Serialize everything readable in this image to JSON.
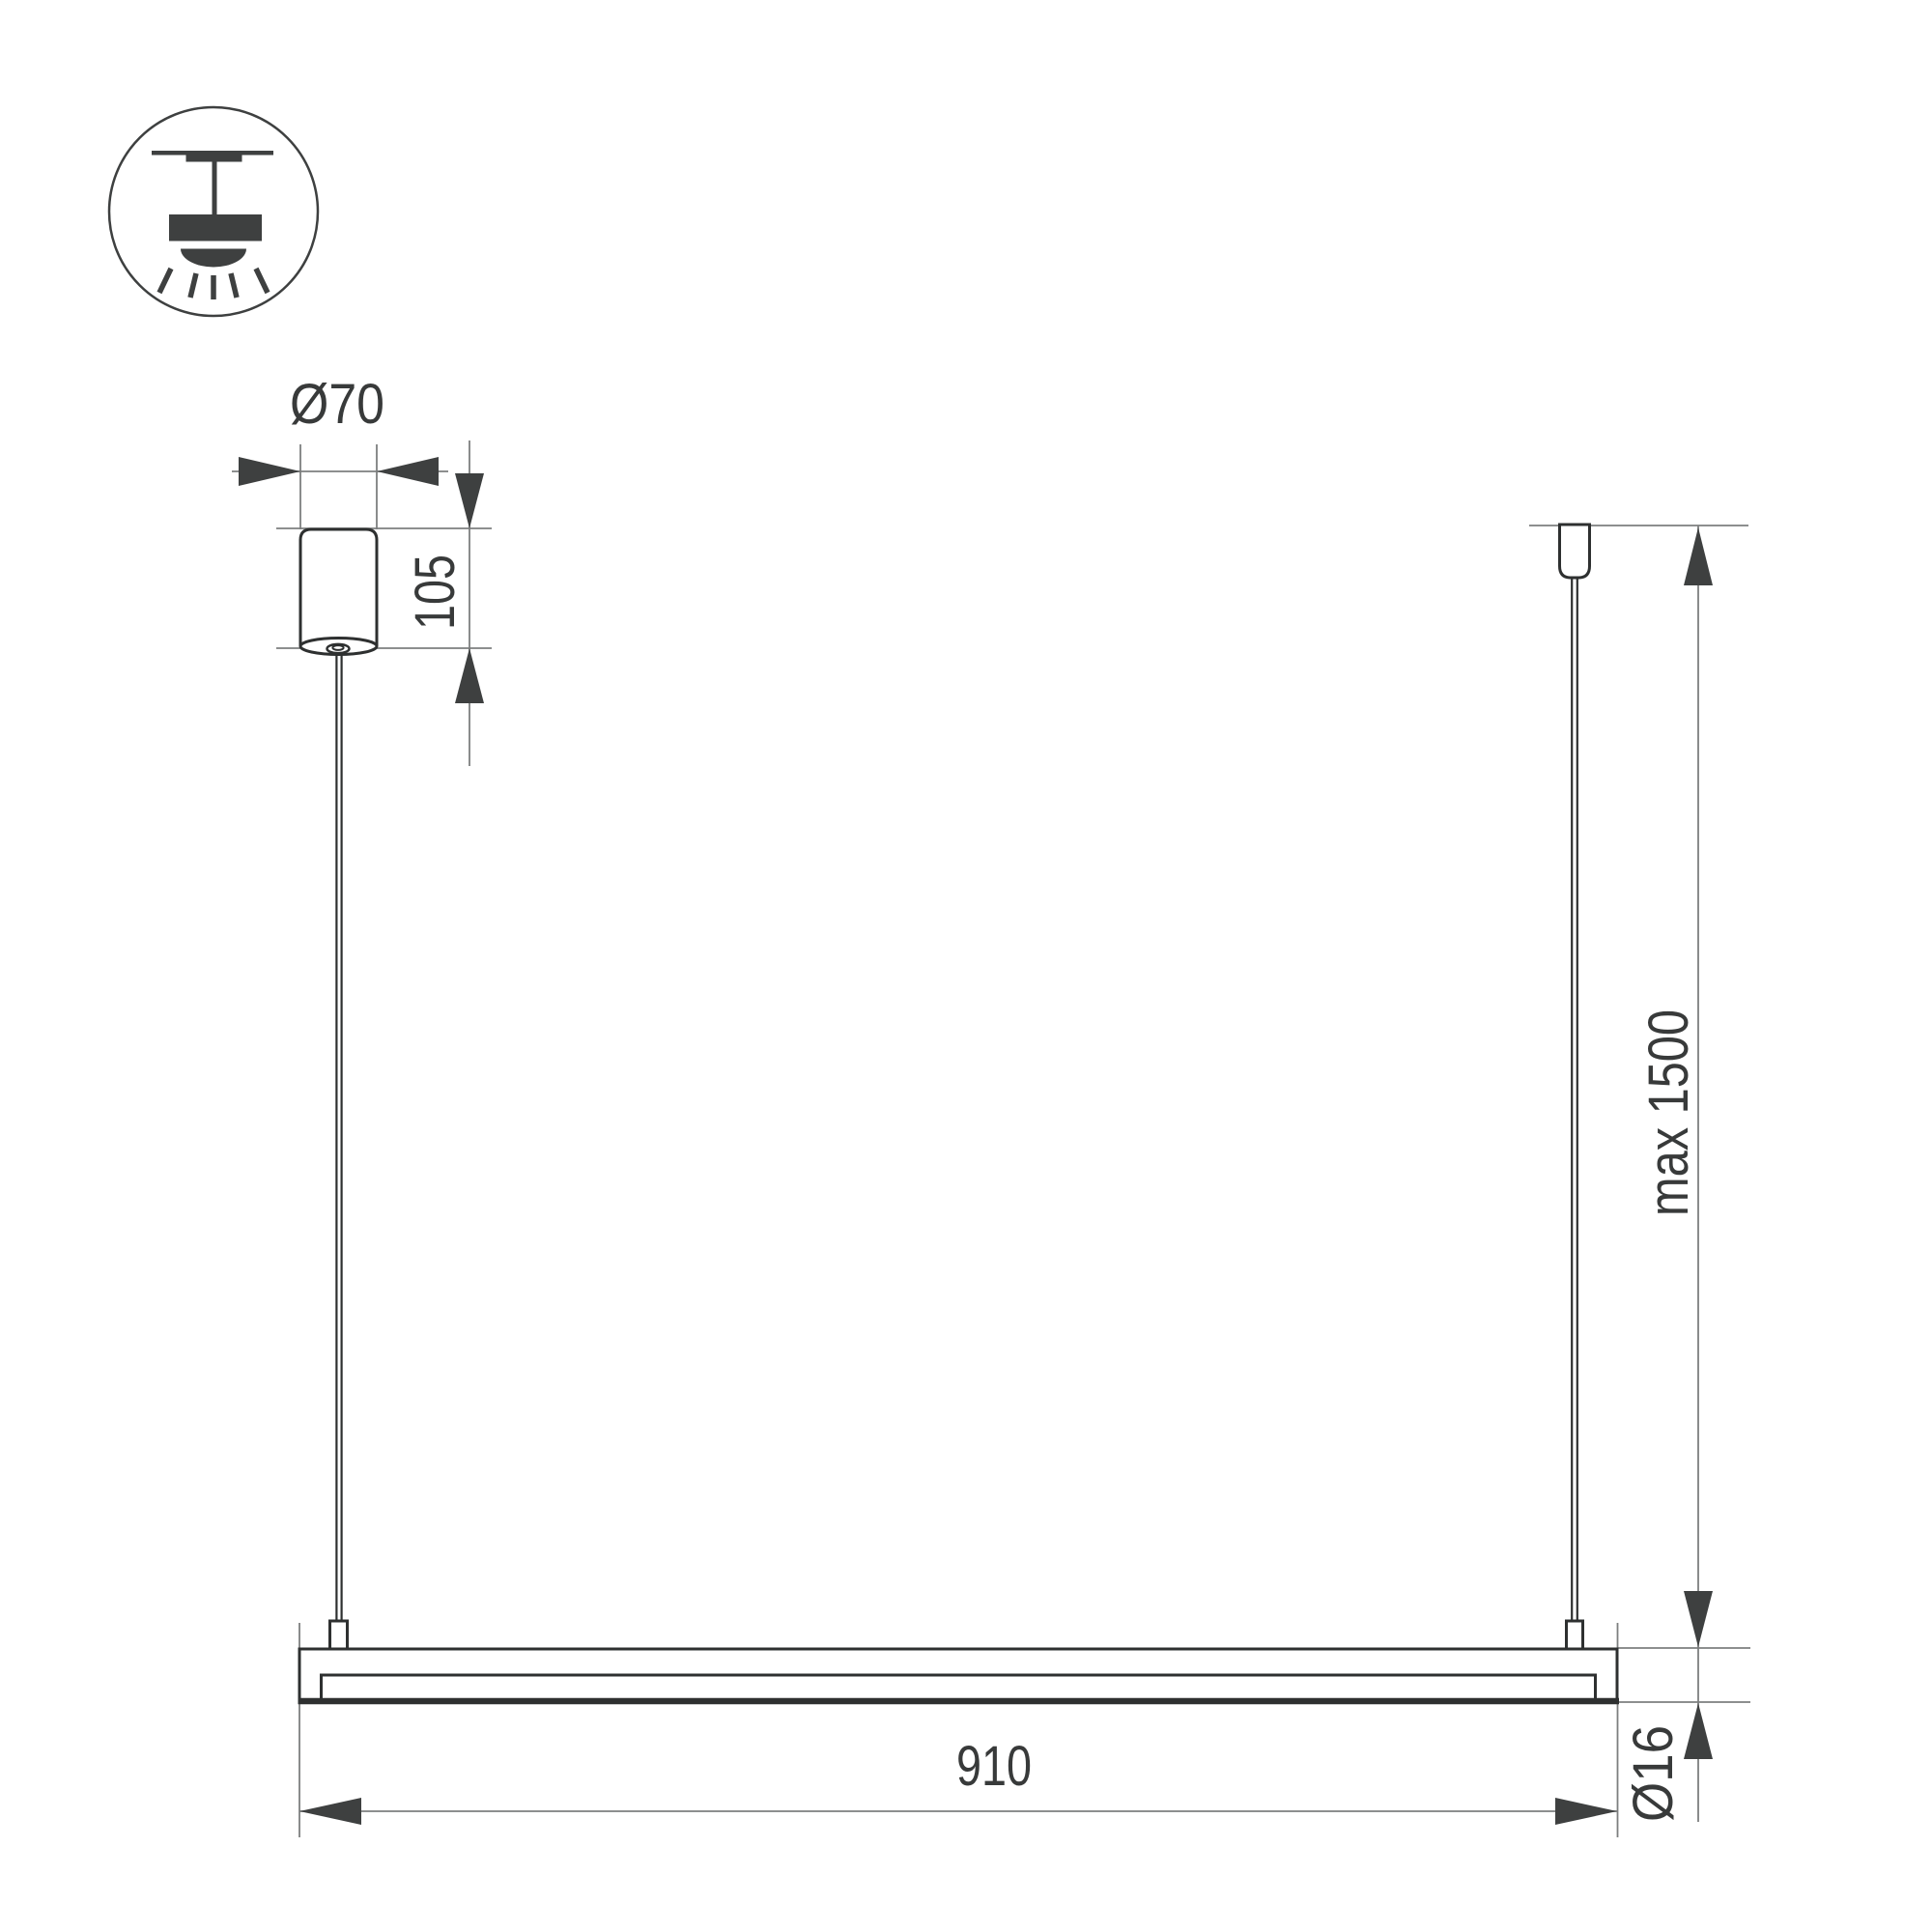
{
  "drawing": {
    "title": "pendant-linear-luminaire-dimension-drawing",
    "icon": "ceiling-pendant-light",
    "labels": {
      "canopy_diameter": "Ø70",
      "canopy_height": "105",
      "suspension_length": "max 1500",
      "fixture_length": "910",
      "fixture_diameter": "Ø16"
    },
    "colors": {
      "outline": "#2e3030",
      "thin_line": "#7d7f7f",
      "arrow_fill": "#3e4040",
      "text": "#383a3a",
      "background": "#ffffff"
    }
  }
}
